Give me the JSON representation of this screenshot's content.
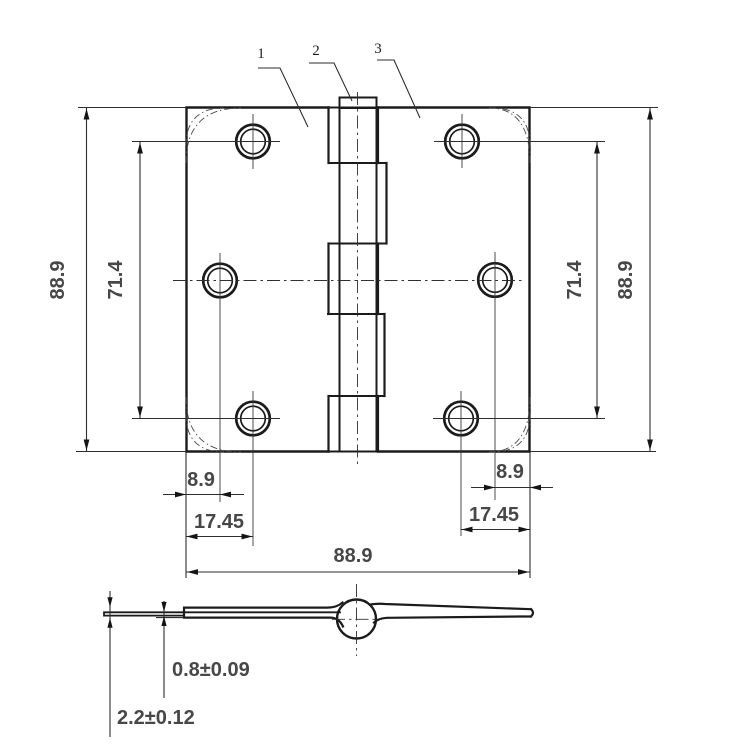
{
  "drawing_type": "hinge-technical-drawing",
  "colors": {
    "background": "#ffffff",
    "line": "#1b1b1b",
    "dim_line": "#2e2e2e",
    "dim_text": "#474747"
  },
  "callouts": [
    {
      "label": "1"
    },
    {
      "label": "2"
    },
    {
      "label": "3"
    }
  ],
  "dims": {
    "left_overall": "88.9",
    "left_hole_span": "71.4",
    "right_hole_span": "71.4",
    "right_overall": "88.9",
    "bottom_overall": "88.9",
    "left_edge_to_hole": "8.9",
    "left_edge_to_far_hole": "17.45",
    "right_edge_to_hole": "8.9",
    "right_edge_to_far_hole": "17.45",
    "single_thickness": "0.8±0.09",
    "total_thickness": "2.2±0.12"
  }
}
